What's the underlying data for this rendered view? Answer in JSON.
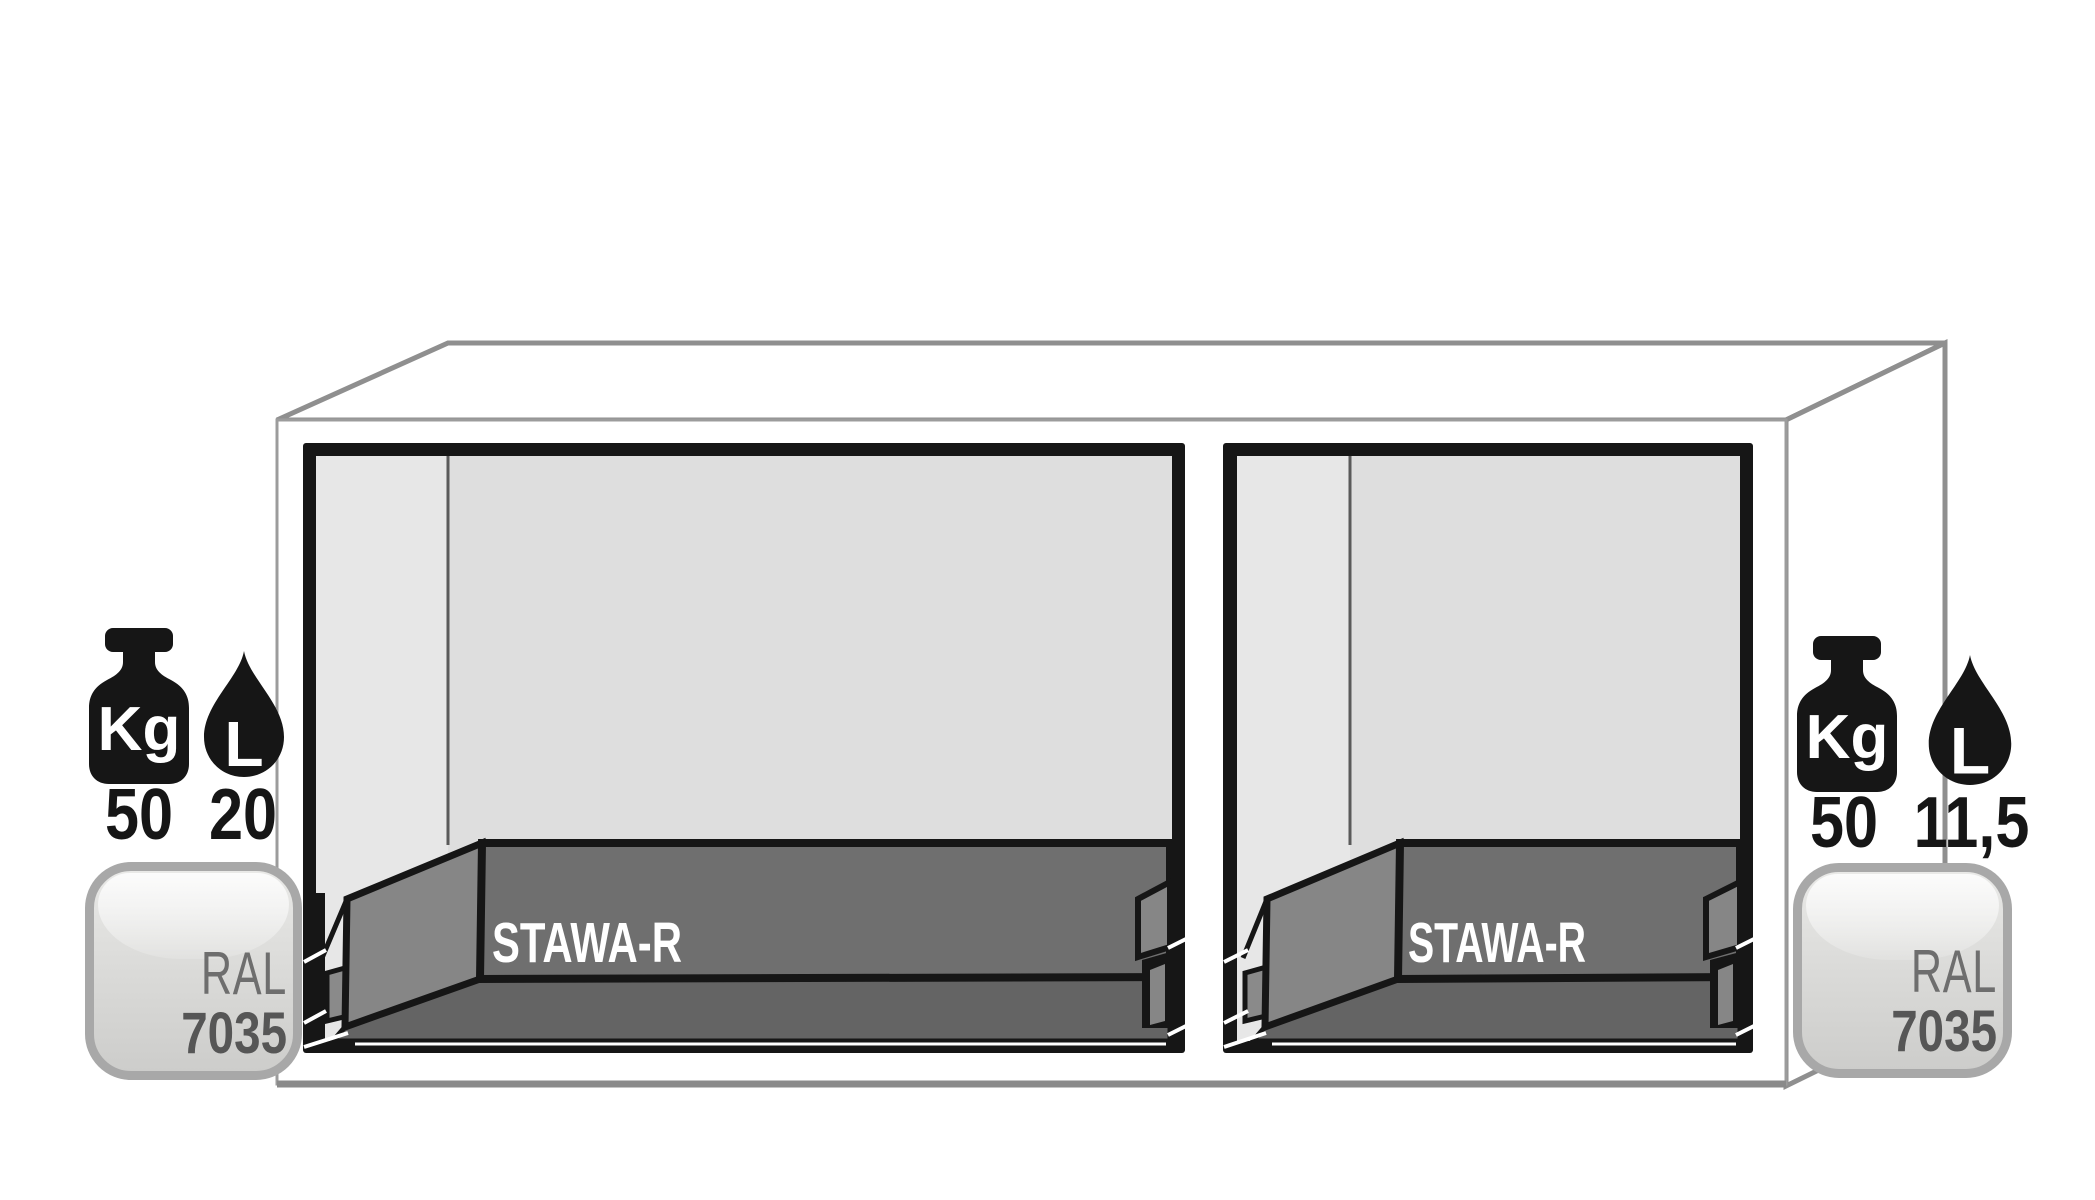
{
  "diagram": {
    "type": "cabinet-cross-section",
    "compartments": [
      {
        "side": "left",
        "drawer_label": "STAWA-R",
        "load_capacity_kg": "50",
        "sump_volume_l": "20",
        "ral_label": "RAL",
        "ral_code": "7035"
      },
      {
        "side": "right",
        "drawer_label": "STAWA-R",
        "load_capacity_kg": "50",
        "sump_volume_l": "11,5",
        "ral_label": "RAL",
        "ral_code": "7035"
      }
    ],
    "icon_labels": {
      "weight_unit": "Kg",
      "volume_unit": "L"
    },
    "colors": {
      "outline": "#161616",
      "interior_back": "#dedede",
      "interior_side": "#e7e7e7",
      "drawer_front": "#6f6f6f",
      "drawer_side": "#868686",
      "drawer_base": "#646464",
      "frame_edge": "#8f8f8f",
      "badge_border": "#a8a8a8",
      "badge_text": "#606060",
      "icon": "#161616"
    }
  }
}
